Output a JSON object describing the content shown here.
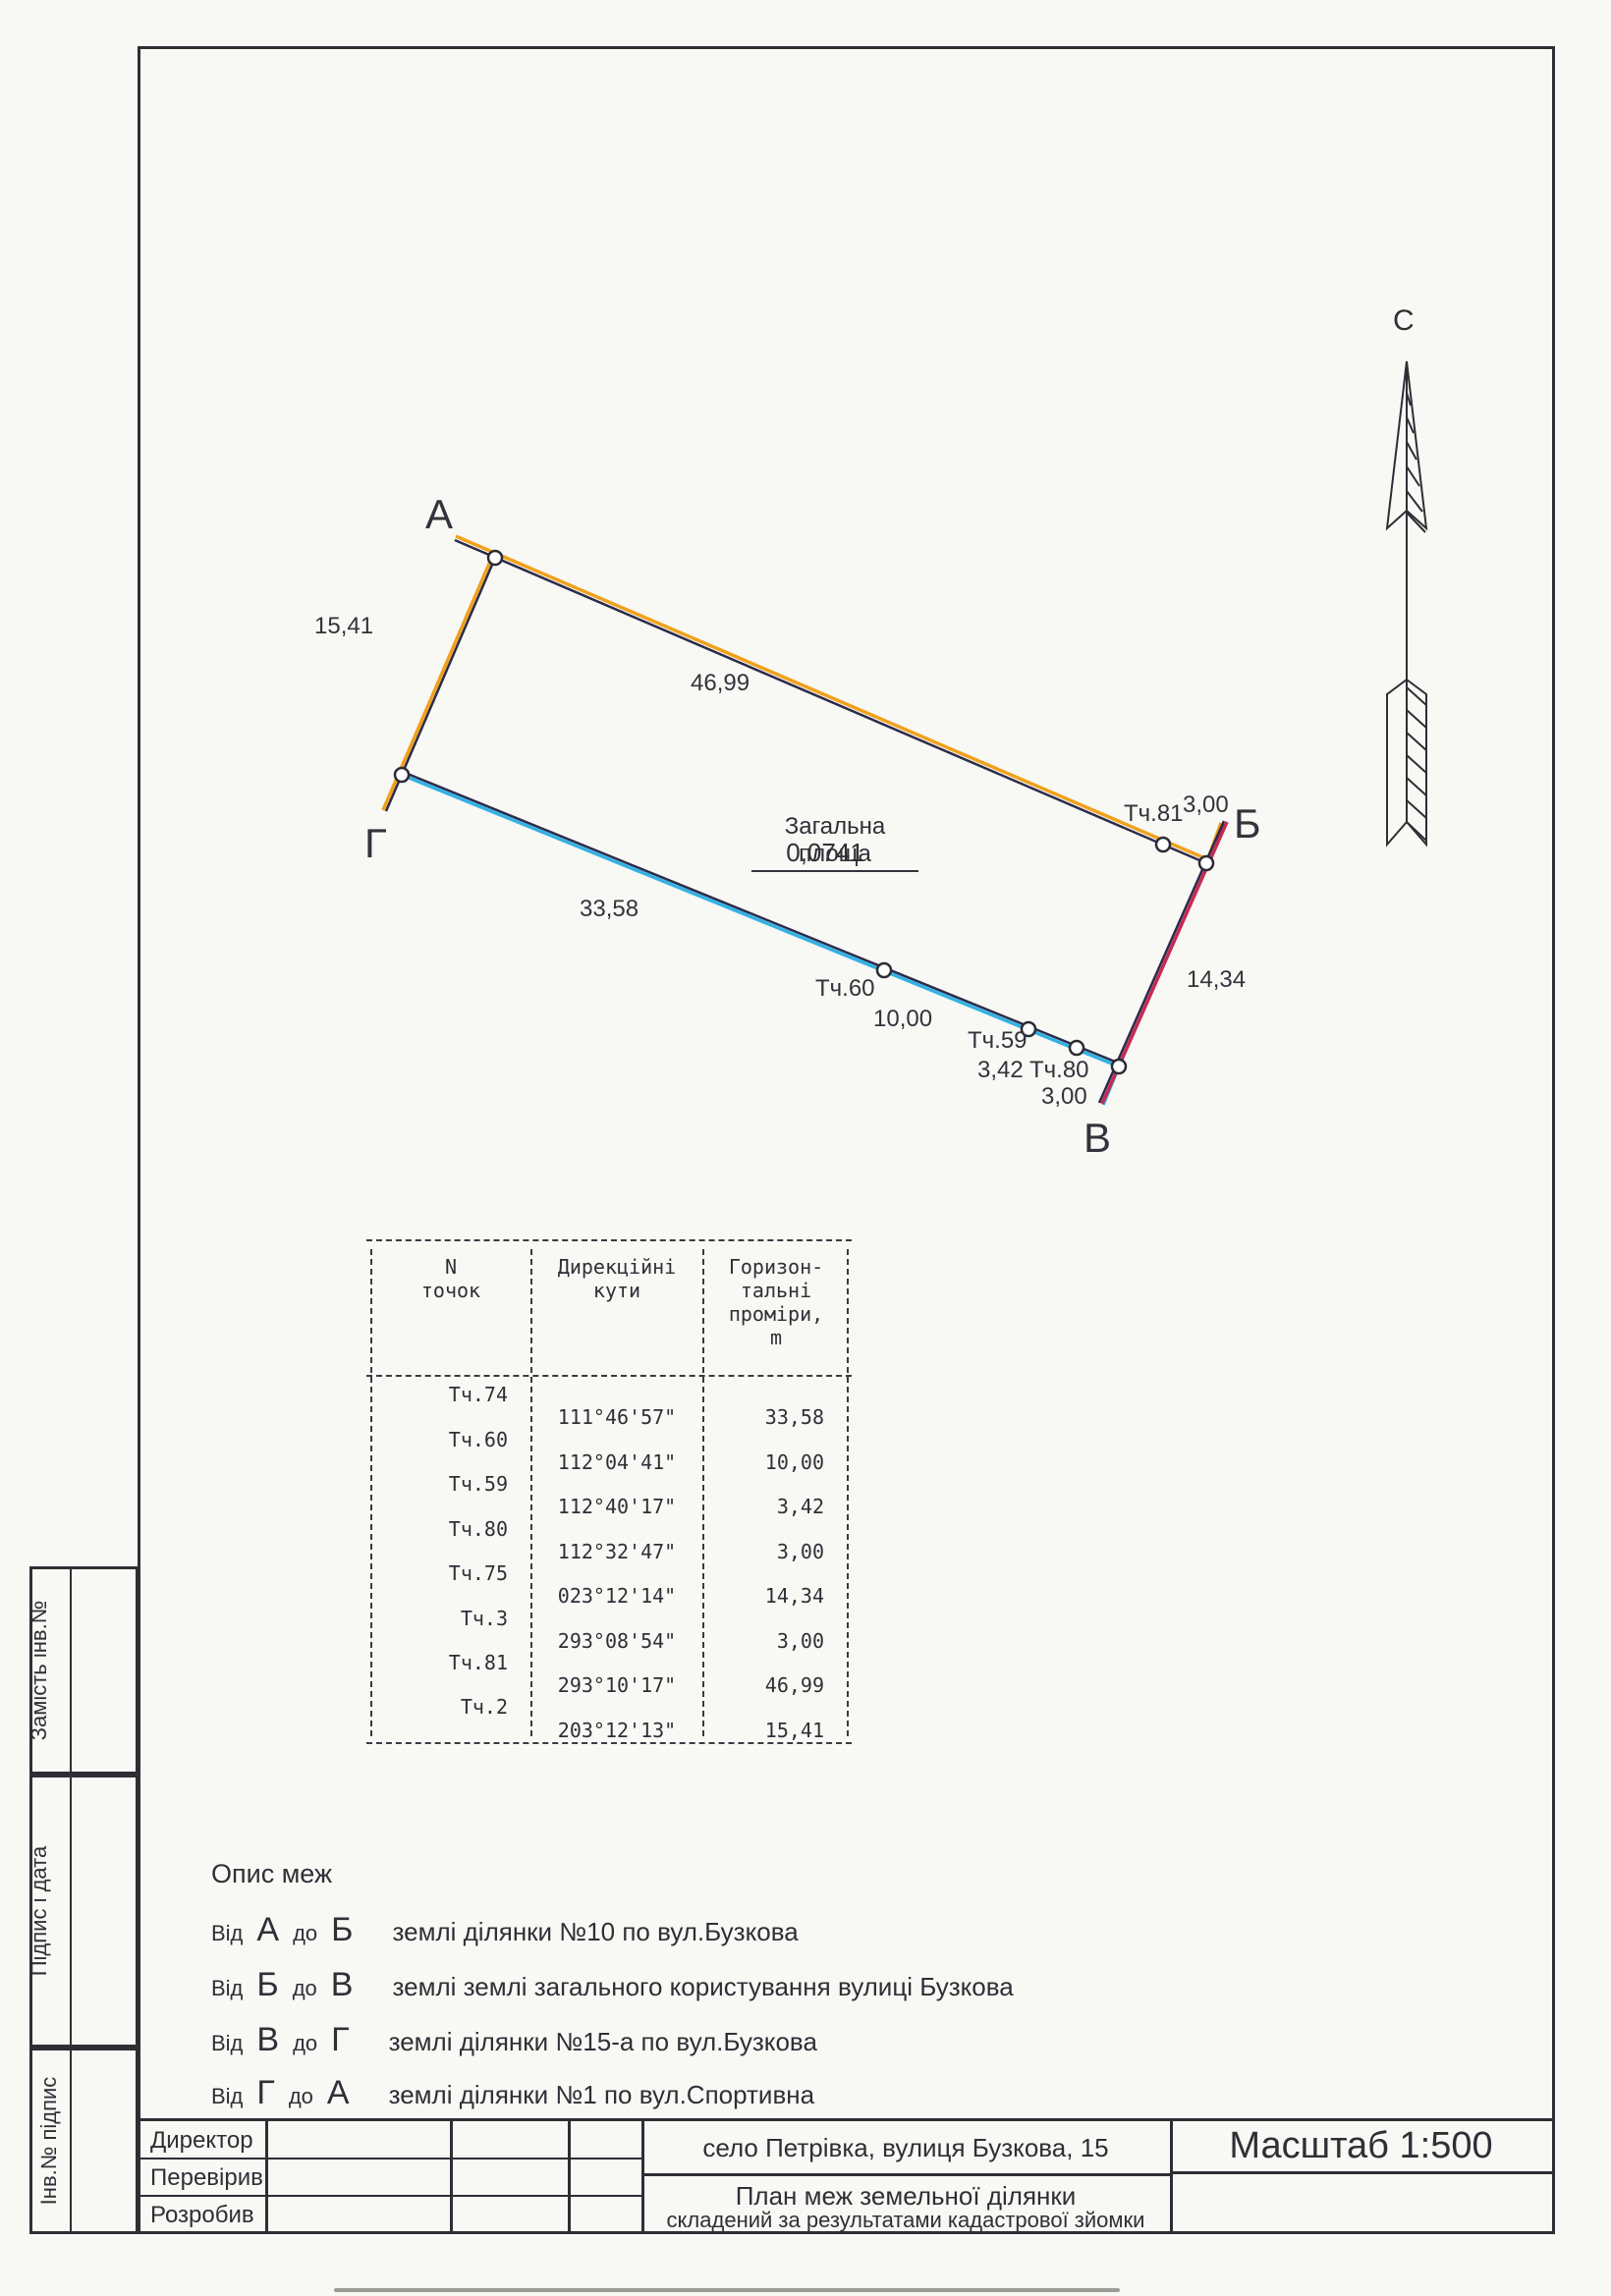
{
  "colors": {
    "ink": "#2e2e34",
    "boundary_ab_orange": "#f0a11c",
    "boundary_gv_cyan": "#33b1e4",
    "boundary_vb_red": "#c62a52"
  },
  "north_arrow": {
    "label": "С"
  },
  "plan": {
    "corners": {
      "a": "А",
      "b": "Б",
      "v": "В",
      "g": "Г"
    },
    "area_title": "Загальна площа",
    "area_value": "0,0741",
    "distances": {
      "ag": "15,41",
      "ab": "46,99",
      "g60": "33,58",
      "s60": "10,00",
      "s59": "3,42",
      "s80": "3,00",
      "vb": "14,34",
      "b81": "3,00"
    },
    "points": {
      "t60": "Тч.60",
      "t59": "Тч.59",
      "t80": "Тч.80",
      "t81": "Тч.81"
    }
  },
  "survey_table": {
    "header": {
      "c1": [
        "N",
        "точок"
      ],
      "c2": [
        "Дирекційні",
        "кути"
      ],
      "c3": [
        "Горизон-",
        "тальні",
        "проміри,",
        "m"
      ]
    },
    "rows": [
      {
        "point": "Тч.74",
        "angle": "111°46'57\"",
        "dist": "33,58"
      },
      {
        "point": "Тч.60",
        "angle": "112°04'41\"",
        "dist": "10,00"
      },
      {
        "point": "Тч.59",
        "angle": "112°40'17\"",
        "dist": "3,42"
      },
      {
        "point": "Тч.80",
        "angle": "112°32'47\"",
        "dist": "3,00"
      },
      {
        "point": "Тч.75",
        "angle": "023°12'14\"",
        "dist": "14,34"
      },
      {
        "point": "Тч.3",
        "angle": "293°08'54\"",
        "dist": "3,00"
      },
      {
        "point": "Тч.81",
        "angle": "293°10'17\"",
        "dist": "46,99"
      },
      {
        "point": "Тч.2",
        "angle": "203°12'13\"",
        "dist": "15,41"
      }
    ]
  },
  "boundaries": {
    "title": "Опис меж",
    "from_word": "Від",
    "to_word": "до",
    "rows": [
      {
        "from": "А",
        "to": "Б",
        "desc": "землі ділянки №10 по вул.Бузкова"
      },
      {
        "from": "Б",
        "to": "В",
        "desc": "землі землі загального користування вулиці Бузкова"
      },
      {
        "from": "В",
        "to": "Г",
        "desc": "землі ділянки №15-а по вул.Бузкова"
      },
      {
        "from": "Г",
        "to": "А",
        "desc": "землі ділянки №1 по вул.Спортивна"
      }
    ]
  },
  "title_block": {
    "roles": [
      "Директор",
      "Перевірив",
      "Розробив"
    ],
    "address": "село Петрівка, вулиця Бузкова, 15",
    "scale": "Масштаб 1:500",
    "doc_title_line1": "План меж земельної ділянки",
    "doc_title_line2": "складений за результатами кадастрової зйомки"
  },
  "sidebar": {
    "labels": [
      "Замість інв.№",
      "Підпис і дата",
      "Інв.№ підпис"
    ]
  }
}
